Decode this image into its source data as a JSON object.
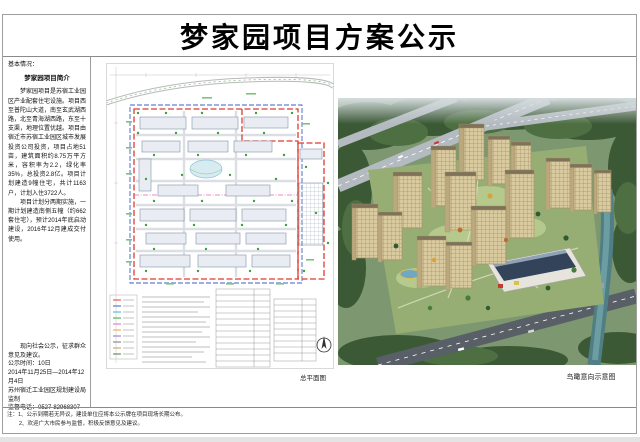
{
  "title": "梦家园项目方案公示",
  "left_panel": {
    "section_label": "基本情况：",
    "intro_title": "梦家园项目简介",
    "paragraph1": "梦家园项目是苏宿工业园区产业配套住宅设施。项目西至普陀山大道，南至玄武湖西路，北至青海湖西路，东至十支渠，地理位置优越。项目由宿迁市苏宿工业园区城市发展投资公司投资，项目占地51亩，建筑面积约8.75万平方米，容积率为2.2，绿化率35%，总投资2.8亿。项目计划建造9幢住宅，共计1163户，计划入住3722人。",
    "paragraph2": "项目计划分两期实施，一期计划建造南侧五幢（约662套住宅），预计2014年底启动建设，2016年12月建成交付使用。",
    "notice_line": "现向社会公示，征求群众意见及建议。",
    "notice_duration": "公示时间：10日",
    "notice_dates": "2014年11月25日—2014年12月4日",
    "issuer": "苏州宿迁工业园区规划建设局监制",
    "phone": "监督电话：0527-82968307"
  },
  "captions": {
    "site_plan": "总平面图",
    "aerial": "鸟瞰意向示意图"
  },
  "footnotes": {
    "line1": "注：1、公示到期若无异议，建设单位应将本公示牌在项目现场长期公布。",
    "line2": "2、欢迎广大市民参与监督，积极反馈意见及建议。"
  },
  "colors": {
    "boundary_red": "#e03a2f",
    "parcel_blue": "#3b62c9",
    "phase_pink": "#e26bb0",
    "tree_green": "#3aa13a",
    "water_teal": "#4f7f84",
    "building_beige": "#d9caa0"
  }
}
